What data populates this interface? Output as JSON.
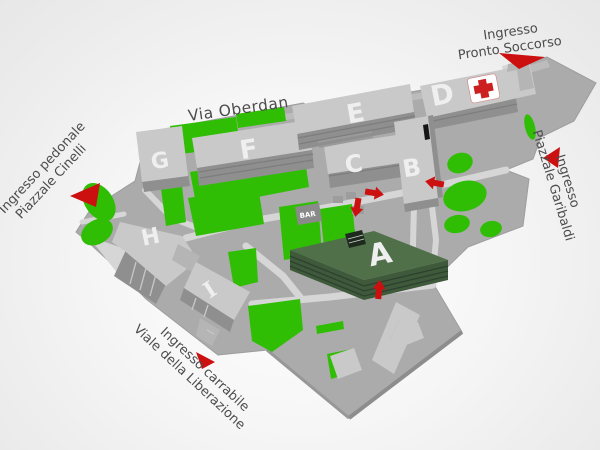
{
  "colors": {
    "ground": "#ababab",
    "road": "#bcbcbc",
    "walkway": "#d6d6d6",
    "green": "#2fbe04",
    "building_top": "#c9c9c9",
    "building_side": "#8f8f8f",
    "building_letter": "#efefef",
    "building_a_top": "#507049",
    "building_a_front": "#3f5a3b",
    "arrow_red": "#cc0f0f",
    "cross_red": "#cc2020",
    "label_text": "#4c4c4c",
    "bar_building": "#8a8a8a"
  },
  "map": {
    "street_label": "Via Oberdan",
    "entrances": {
      "pronto_soccorso": {
        "line1": "Ingresso",
        "line2": "Pronto Soccorso"
      },
      "garibaldi": {
        "line1": "Ingresso",
        "line2": "Piazzale Garibaldi"
      },
      "cinelli": {
        "line1": "Ingresso pedonale",
        "line2": "Piazzale Cinelli"
      },
      "liberazione": {
        "line1": "Ingresso carrabile",
        "line2": "Viale della Liberazione"
      }
    },
    "buildings": {
      "a": "A",
      "b": "B",
      "c": "C",
      "d": "D",
      "e": "E",
      "f": "F",
      "g": "G",
      "h": "H",
      "i": "I"
    },
    "poi": {
      "bar": "BAR"
    },
    "icons": {
      "emergency": "red-cross",
      "entrance_marker": "red-arrow"
    }
  }
}
